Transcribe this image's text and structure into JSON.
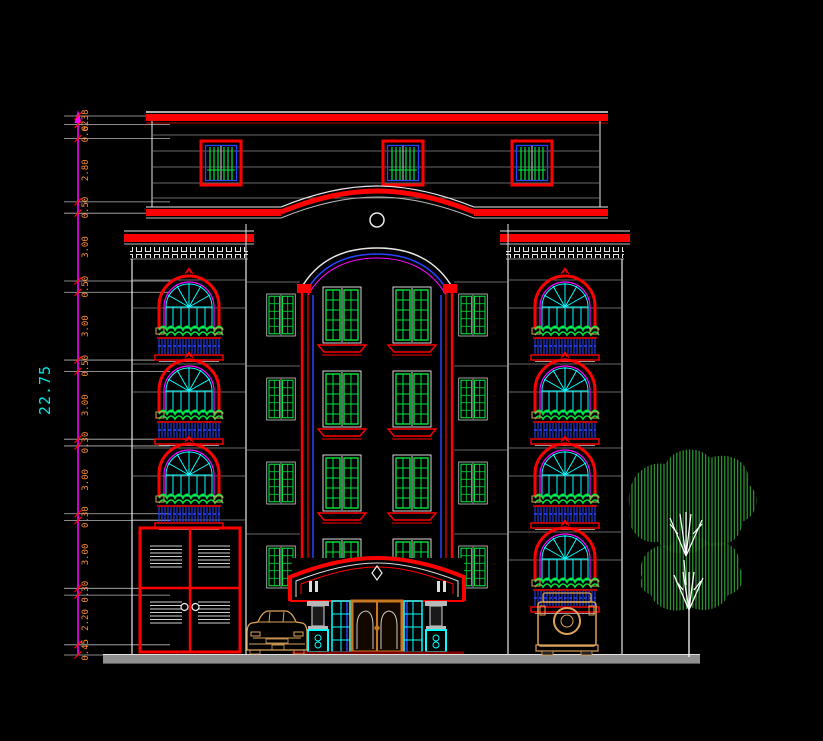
{
  "canvas": {
    "width": 823,
    "height": 741,
    "background": "#000000"
  },
  "dimension_chain": {
    "overall_label": "22.75",
    "segment_labels_top_to_bottom": [
      "0.38",
      "0.62",
      "2.80",
      "0.50",
      "3.00",
      "0.50",
      "3.00",
      "0.50",
      "3.00",
      "0.30",
      "3.00",
      "0.30",
      "3.00",
      "0.30",
      "2.20",
      "0.45"
    ]
  },
  "scene": {
    "type": "building-front-elevation",
    "top_floor_windows": 3,
    "left_tower_balcony_windows": 3,
    "right_tower_balcony_windows": 4,
    "central_window_rows": 4,
    "central_window_columns": 4,
    "garage_louver_panels": 4,
    "vehicles": [
      "sedan-front-view",
      "suv-rear-view"
    ],
    "trees": 1
  },
  "palette": {
    "red": "#ff0000",
    "dark_red": "#7a0000",
    "white_line": "#e8e8e8",
    "grey_line": "#8a8a8a",
    "green": "#00e53c",
    "tree_green": "#2f9e35",
    "cyan": "#00ffff",
    "cyan_text": "#00e6e6",
    "blue": "#2943ff",
    "magenta": "#ff00ff",
    "dim_orange": "#ff8c33",
    "tan": "#dca35a",
    "ground_grey": "#8f8f8f"
  }
}
